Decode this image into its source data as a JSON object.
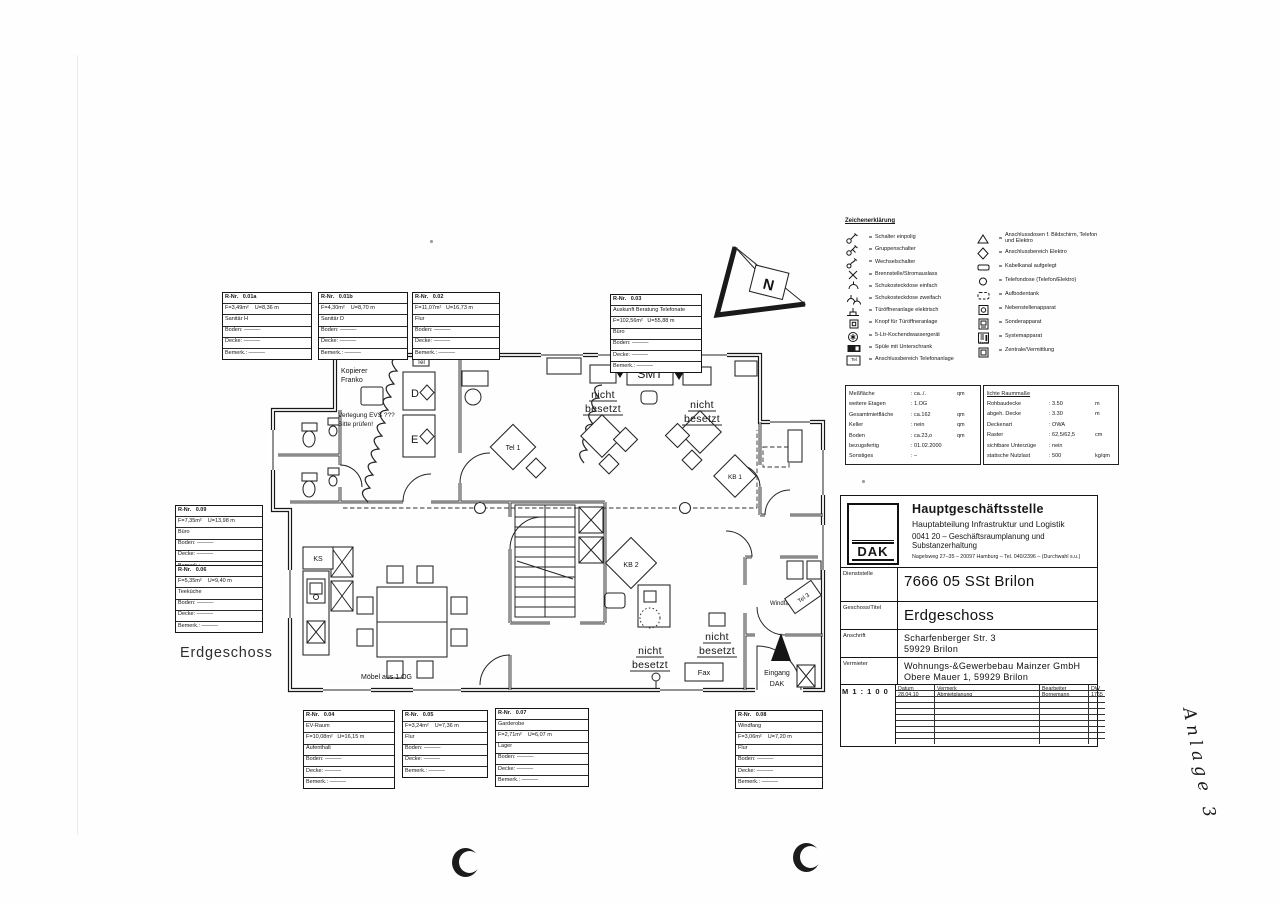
{
  "page": {
    "floor_label": "Erdgeschoss",
    "handwritten_note": "Anlage 3"
  },
  "legend": {
    "title": "Zeichenerklärung",
    "separator": "=",
    "left": [
      {
        "icon": "switch-single",
        "label": "Schalter einpolig"
      },
      {
        "icon": "switch-group",
        "label": "Gruppenschalter"
      },
      {
        "icon": "switch-changeover",
        "label": "Wechselschalter"
      },
      {
        "icon": "outlet-cross",
        "label": "Brennstelle/Stromauslass"
      },
      {
        "icon": "socket-single",
        "label": "Schukosteckdose einfach"
      },
      {
        "icon": "socket-double",
        "label": "Schukosteckdose zweifach"
      },
      {
        "icon": "door-opener",
        "label": "Türöffneranlage elektrisch"
      },
      {
        "icon": "door-opener-button",
        "label": "Knopf für Türöffneranlage"
      },
      {
        "icon": "water-heater",
        "label": "5-Ltr-Kochendwassergerät"
      },
      {
        "icon": "sink-unit",
        "label": "Spüle mit Unterschrank"
      },
      {
        "icon": "tel-area",
        "label": "Anschlussbereich Telefonanlage",
        "icon_text": "Tel"
      }
    ],
    "right": [
      {
        "icon": "conn-triangle",
        "label": "Anschlussdosen f. Bildschirm, Telefon und Elektro"
      },
      {
        "icon": "conn-diamond",
        "label": "Anschlussbereich Elektro"
      },
      {
        "icon": "cable-duct",
        "label": "Kabelkanal aufgelegt"
      },
      {
        "icon": "phone-socket",
        "label": "Telefondose (Telefon/Elektro)"
      },
      {
        "icon": "floor-tank",
        "label": "Aufbodentank"
      },
      {
        "icon": "extension-phone",
        "label": "Nebenstellenapparat"
      },
      {
        "icon": "special-phone",
        "label": "Sonderapparat"
      },
      {
        "icon": "system-phone",
        "label": "Systemapparat"
      },
      {
        "icon": "pbx",
        "label": "Zentrale/Vermittlung",
        "icon_text": "Zentr."
      }
    ]
  },
  "specs_left": {
    "rows": [
      [
        "Meßfläche",
        ": ca../.",
        "qm"
      ],
      [
        "weitere Etagen",
        ": 1.OG",
        ""
      ],
      [
        "Gesamtmietfläche",
        ": ca.162",
        "qm"
      ],
      [
        "Keller",
        ": nein",
        "qm"
      ],
      [
        "Boden",
        ": ca.23,o",
        "qm"
      ],
      [
        "bezugsfertig",
        ": 01.02.2000",
        ""
      ],
      [
        "Sonstiges",
        ": –",
        ""
      ]
    ]
  },
  "specs_right": {
    "title": "lichte Raummaße",
    "rows": [
      [
        "Rohbaudecke",
        ": 3.50",
        "m"
      ],
      [
        "abgeh. Decke",
        ": 3.30",
        "m"
      ],
      [
        "Deckenart",
        ": OWA",
        ""
      ],
      [
        "Raster",
        ": 62,5/62,5",
        "cm"
      ],
      [
        "sichtbare Unterzüge",
        ": nein",
        ""
      ],
      [
        "statische Nutzlast",
        ": 500",
        "kg/qm"
      ]
    ]
  },
  "title_block": {
    "logo": "DAK",
    "org_line1": "Hauptgeschäftsstelle",
    "org_line2": "Hauptabteilung Infrastruktur und Logistik",
    "org_line3": "0041 20 – Geschäftsraumplanung und Substanzerhaltung",
    "org_line4": "Nagelsweg 27–35 – 20097 Hamburg – Tel. 040/2396 – (Durchwahl s.u.)",
    "field1_label": "Dienststelle",
    "field1_value": "7666 05 SSt Brilon",
    "field2_label": "Geschoss/Titel",
    "field2_value": "Erdgeschoss",
    "field3_label": "Anschrift",
    "field3_value1": "Scharfenberger Str. 3",
    "field3_value2": "59929 Brilon",
    "field4_label": "Vermieter",
    "field4_value1": "Wohnungs-&Gewerbebau Mainzer GmbH",
    "field4_value2": "Obere Mauer 1,  59929 Brilon",
    "scale": "M 1 : 1 0 0",
    "revision_headers": [
      "Datum",
      "Vermerk",
      "Bearbeiter",
      "DW"
    ],
    "revisions": [
      [
        "28.04.10",
        "Abmietplanung",
        "Bornemann",
        "1765"
      ]
    ]
  },
  "rooms": [
    {
      "rows": [
        "R-Nr.   0.01a",
        "F=3,49m²    U=8,36 m",
        "Sanitär H",
        "Boden: ———",
        "Decke: ———",
        "Bemerk.: ———"
      ]
    },
    {
      "rows": [
        "R-Nr.   0.01b",
        "F=4,30m²    U=8,70 m",
        "Sanitär D",
        "Boden: ———",
        "Decke: ———",
        "Bemerk.: ———"
      ]
    },
    {
      "rows": [
        "R-Nr.   0.02",
        "F=11,07m²   U=16,73 m",
        "Flur",
        "Boden: ———",
        "Decke: ———",
        "Bemerk.: ———"
      ]
    },
    {
      "rows": [
        "R-Nr.   0.03",
        "Auskunft Beratung Telefonate",
        "F=102,56m²   U=55,88 m",
        "Büro",
        "Boden: ———",
        "Decke: ———",
        "Bemerk.: ———"
      ]
    },
    {
      "rows": [
        "R-Nr.   0.09",
        "F=7,35m²    U=13,98 m",
        "Büro",
        "Boden: ———",
        "Decke: ———",
        "Bemerk.: ———"
      ]
    },
    {
      "rows": [
        "R-Nr.   0.06",
        "F=5,35m²    U=9,40 m",
        "Teeküche",
        "Boden: ———",
        "Decke: ———",
        "Bemerk.: ———"
      ]
    },
    {
      "rows": [
        "R-Nr.   0.04",
        "EV-Raum",
        "F=10,08m²   U=16,15 m",
        "Aufenthalt",
        "Boden: ———",
        "Decke: ———",
        "Bemerk.: ———"
      ]
    },
    {
      "rows": [
        "R-Nr.   0.05",
        "F=3,24m²    U=7,36 m",
        "Flur",
        "Boden: ———",
        "Decke: ———",
        "Bemerk.: ———"
      ]
    },
    {
      "rows": [
        "R-Nr.   0.07",
        "Garderobe",
        "F=2,71m²    U=6,07 m",
        "Lager",
        "Boden: ———",
        "Decke: ———",
        "Bemerk.: ———"
      ]
    },
    {
      "rows": [
        "R-Nr.   0.08",
        "Windfang",
        "F=3,06m²    U=7,20 m",
        "Flur",
        "Boden: ———",
        "Decke: ———",
        "Bemerk.: ———"
      ]
    }
  ],
  "plan": {
    "labels": {
      "kopierer_1": "Kopierer",
      "kopierer_2": "Franko",
      "verlegung_1": "Verlegung EVS ???",
      "verlegung_2": "Bitte prüfen!",
      "tel_small": "Tel",
      "closet_d": "D",
      "closet_e": "E",
      "smt": "SMT",
      "tel1": "Tel 1",
      "tel3": "Tel 3",
      "kb1": "KB 1",
      "kb2": "KB 2",
      "nicht": "nicht",
      "besetzt": "besetzt",
      "ks": "KS",
      "moebel": "Möbel aus 1.OG",
      "windfang": "Windfang",
      "fax": "Fax",
      "eingang_1": "Eingang",
      "eingang_2": "DAK",
      "north": "N"
    }
  }
}
